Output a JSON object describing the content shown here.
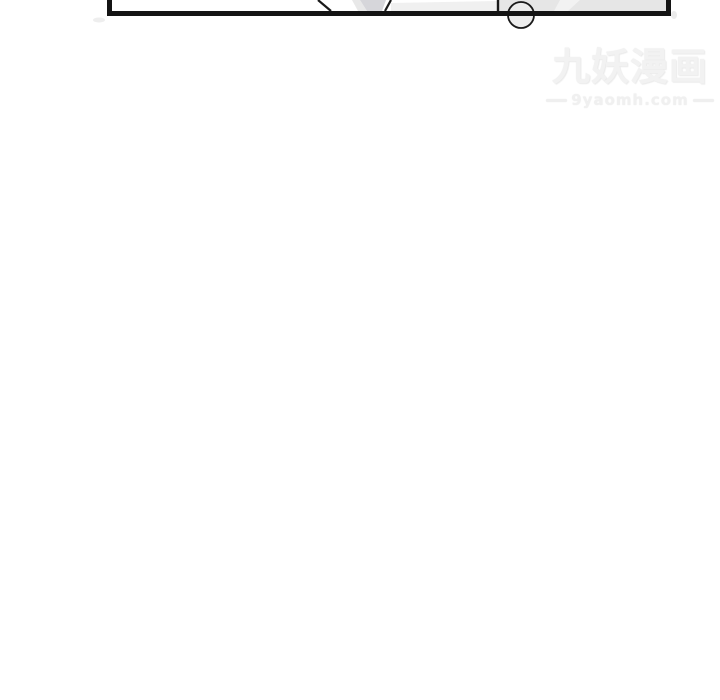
{
  "page": {
    "background": "#ffffff"
  },
  "colors": {
    "panel_ink": "#141414",
    "panel_gray_fill": "#e6e6e6",
    "panel_soft_gray": "#f0f0f0",
    "panel_wedge_gray": "#d6d6da",
    "watermark_gray": "#f0f0f0"
  },
  "watermark": {
    "title": "九妖漫画",
    "url": "9yaomh.com"
  }
}
